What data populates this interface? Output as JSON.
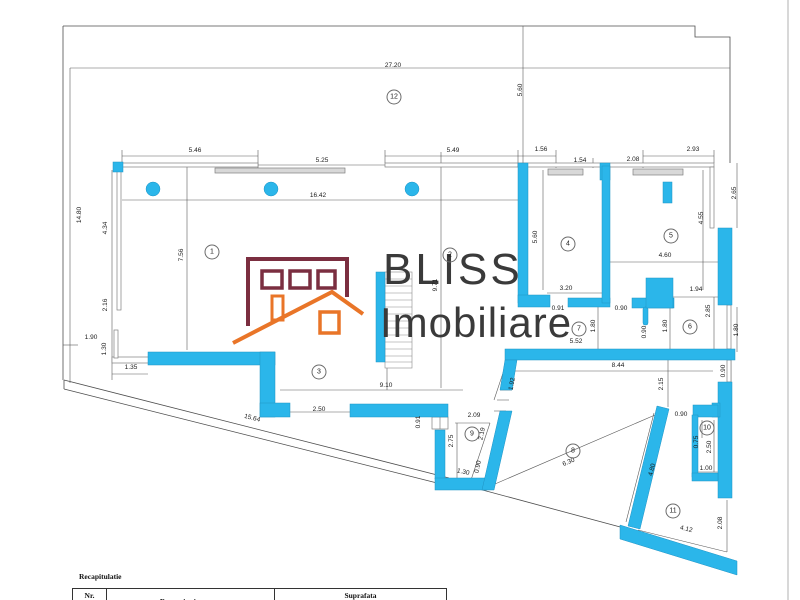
{
  "colors": {
    "wall_cyan": "#2bb6ea",
    "line_gray": "#4d4d4d",
    "logo_maroon": "#7b2e40",
    "logo_orange": "#e97528",
    "logo_text": "#3a3a3a"
  },
  "logo": {
    "line1": "BLISS",
    "line2": "Imobiliare"
  },
  "rooms": [
    {
      "num": "1"
    },
    {
      "num": "2"
    },
    {
      "num": "3"
    },
    {
      "num": "4"
    },
    {
      "num": "5"
    },
    {
      "num": "6"
    },
    {
      "num": "7"
    },
    {
      "num": "8"
    },
    {
      "num": "9"
    },
    {
      "num": "10"
    },
    {
      "num": "11"
    },
    {
      "num": "12"
    }
  ],
  "dims": [
    {
      "t": "27.20"
    },
    {
      "t": "5.60"
    },
    {
      "t": "5.46"
    },
    {
      "t": "5.25"
    },
    {
      "t": "5.49"
    },
    {
      "t": "1.56"
    },
    {
      "t": "1.54"
    },
    {
      "t": "2.08"
    },
    {
      "t": "2.93"
    },
    {
      "t": "16.42"
    },
    {
      "t": "14.80"
    },
    {
      "t": "4.34"
    },
    {
      "t": "7.56"
    },
    {
      "t": "2.16"
    },
    {
      "t": "1.90"
    },
    {
      "t": "1.30"
    },
    {
      "t": "1.35"
    },
    {
      "t": "9.71"
    },
    {
      "t": "5.60"
    },
    {
      "t": "3.20"
    },
    {
      "t": "0.91"
    },
    {
      "t": "0.90"
    },
    {
      "t": "4.60"
    },
    {
      "t": "4.55"
    },
    {
      "t": "2.65"
    },
    {
      "t": "1.94"
    },
    {
      "t": "2.85"
    },
    {
      "t": "1.80"
    },
    {
      "t": "1.80"
    },
    {
      "t": "0.90"
    },
    {
      "t": "1.80"
    },
    {
      "t": "5.52"
    },
    {
      "t": "8.44"
    },
    {
      "t": "2.15"
    },
    {
      "t": "0.90"
    },
    {
      "t": "9.10"
    },
    {
      "t": "15.64"
    },
    {
      "t": "2.50"
    },
    {
      "t": "2.09"
    },
    {
      "t": "0.91"
    },
    {
      "t": "2.75"
    },
    {
      "t": "2.19"
    },
    {
      "t": "1.92"
    },
    {
      "t": "1.30"
    },
    {
      "t": "0.90"
    },
    {
      "t": "6.30"
    },
    {
      "t": "0.90"
    },
    {
      "t": "0.75"
    },
    {
      "t": "2.50"
    },
    {
      "t": "1.00"
    },
    {
      "t": "4.80"
    },
    {
      "t": "4.12"
    },
    {
      "t": "2.08"
    }
  ],
  "table": {
    "title": "Recapitulatie",
    "col_nr": "Nr.",
    "col_name": "Denumire incapere",
    "col_area": "Suprafata"
  }
}
